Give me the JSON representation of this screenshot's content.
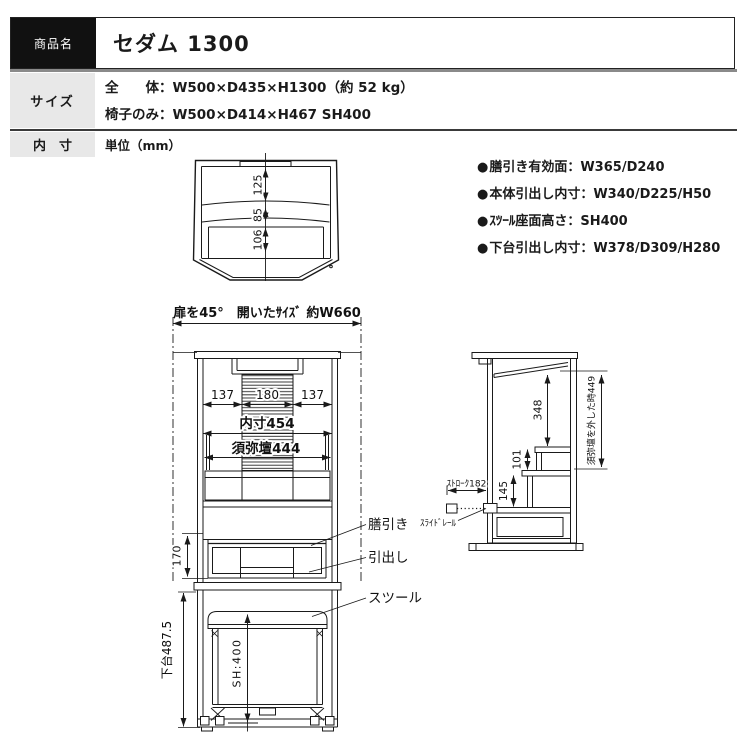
{
  "header": {
    "product_label": "商品名",
    "product_name": "セダム 1300",
    "size_label": "サイズ",
    "size_line1": "全　　体：W500×D435×H1300（約 52 kg）",
    "size_line2": "椅子のみ：W500×D414×H467 SH400",
    "inner_label": "内　寸",
    "unit_note": "単位（mm）"
  },
  "specs": {
    "bullet": "●",
    "items": [
      "膳引き有効面：W365/D240",
      "本体引出し内寸：W340/D225/H50",
      "ｽﾂｰﾙ座面高さ：SH400",
      "下台引出し内寸：W378/D309/H280"
    ]
  },
  "drawing": {
    "top_view": {
      "depth_back": "125",
      "depth_mid": "85",
      "depth_front": "106"
    },
    "front": {
      "doors_open": "扉を45°　開いたｻｲｽﾞ 約W660",
      "left": "137",
      "center": "180",
      "right": "137",
      "inner_width": "内寸454",
      "shumidan": "須弥壇444",
      "drawer_h": "170",
      "lower_h": "下台487.5",
      "seat_h": "SH:400",
      "label_tray": "膳引き",
      "label_drawer": "引出し",
      "label_stool": "スツール"
    },
    "side": {
      "h348": "348",
      "h101": "101",
      "h145": "145",
      "stroke": "ｽﾄﾛｰｸ182",
      "slide_rail": "ｽﾗｲﾄﾞﾚｰﾙ",
      "removed": "須弥壇を外した時449"
    }
  },
  "colors": {
    "ink": "#1a1a1a",
    "cell_bg": "#e8e8e8",
    "header_cell_bg": "#111111",
    "divider_gray": "#8a8a8a",
    "divider_dark": "#333333"
  }
}
